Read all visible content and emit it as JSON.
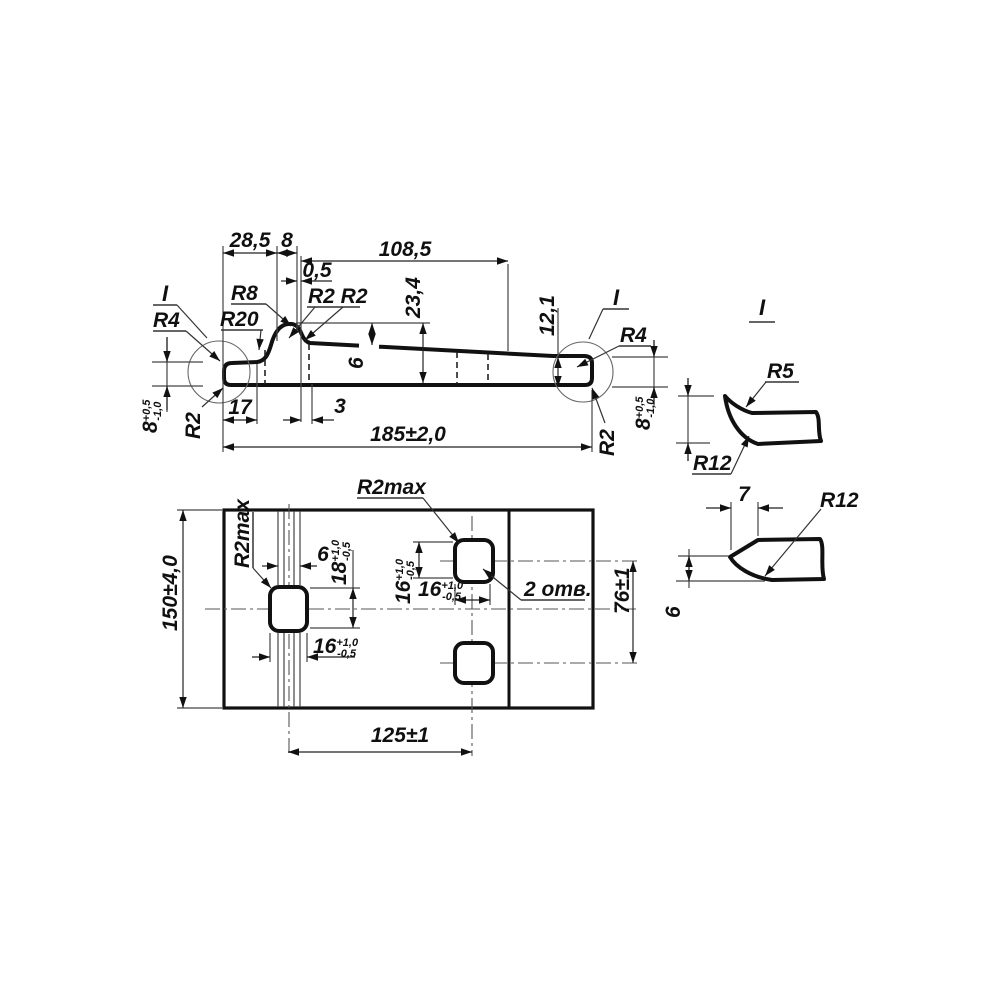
{
  "drawing": {
    "ink_color": "#111111",
    "background": "#ffffff"
  },
  "side_view": {
    "detail_mark_left": "I",
    "detail_mark_right": "I",
    "dim_28_5": "28,5",
    "dim_8": "8",
    "dim_108_5": "108,5",
    "dim_0_5": "0,5",
    "dim_23_4": "23,4",
    "dim_12_1": "12,1",
    "dim_6": "6",
    "dim_17": "17",
    "dim_3": "3",
    "dim_total": "185±2,0",
    "r8": "R8",
    "r20": "R20",
    "r2_pair": "R2 R2",
    "r4_left": "R4",
    "r4_right": "R4",
    "r2_left": "R2",
    "r2_right": "R2",
    "thickness": {
      "value": "8",
      "plus": "+0,5",
      "minus": "-1,0"
    }
  },
  "plan_view": {
    "dim_height": "150±4,0",
    "dim_groove": "6",
    "r2max_top": "R2max",
    "r2max_left": "R2max",
    "hole_height": {
      "value": "18",
      "plus": "+1,0",
      "minus": "-0,5"
    },
    "hole_width": {
      "value": "16",
      "plus": "+1,0",
      "minus": "-0,5"
    },
    "holes_note": "2 отв.",
    "dim_spacing": "76±1",
    "dim_offset": "125±1"
  },
  "detail_views": {
    "title": "I",
    "r5": "R5",
    "r12_upper": "R12",
    "r12_lower": "R12",
    "dim_7": "7",
    "dim_6": "6"
  }
}
